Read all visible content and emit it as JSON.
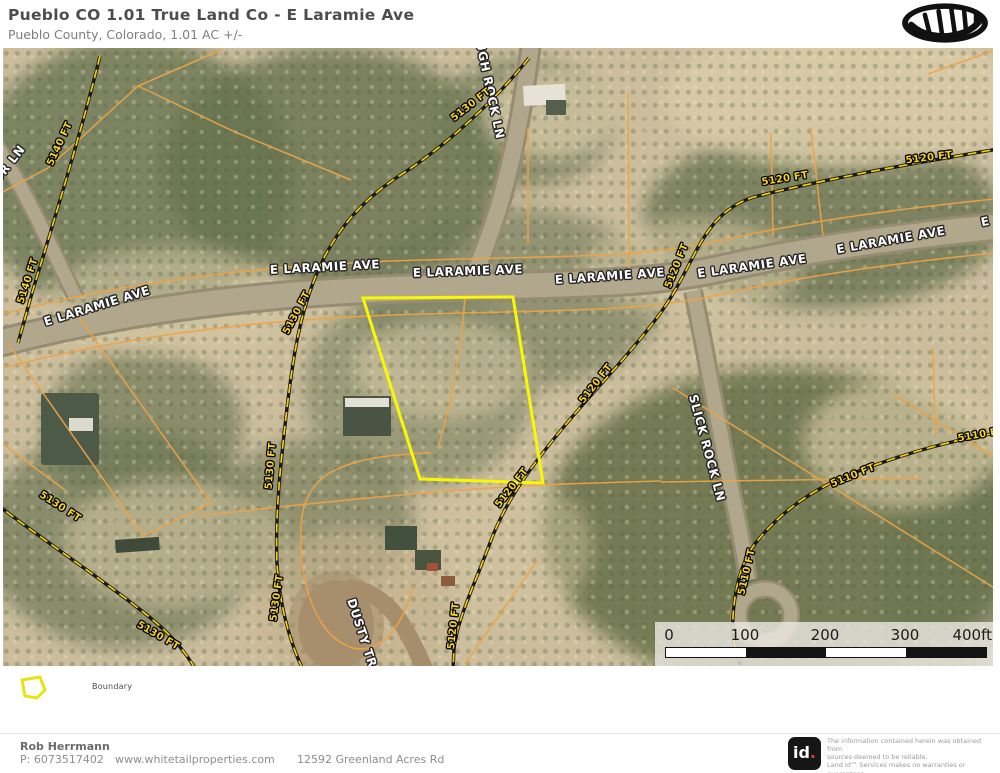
{
  "header": {
    "title": "Pueblo CO 1.01 True Land Co - E Laramie Ave",
    "subtitle": "Pueblo County, Colorado, 1.01 AC +/-"
  },
  "map": {
    "boundary_color": "#f8f800",
    "contour_color": "#f3cd0a",
    "parcel_color": "#efa344",
    "road_labels": [
      {
        "text": "E LARAMIE AVE",
        "x": 94,
        "y": 258,
        "rot": -17
      },
      {
        "text": "E LARAMIE AVE",
        "x": 322,
        "y": 219,
        "rot": -3
      },
      {
        "text": "E LARAMIE AVE",
        "x": 465,
        "y": 223,
        "rot": -2
      },
      {
        "text": "E LARAMIE AVE",
        "x": 607,
        "y": 228,
        "rot": -4
      },
      {
        "text": "E LARAMIE AVE",
        "x": 749,
        "y": 218,
        "rot": -8
      },
      {
        "text": "E LARAMIE AVE",
        "x": 888,
        "y": 192,
        "rot": -10
      },
      {
        "text": "E LARAMIE AVE",
        "x": 1032,
        "y": 163,
        "rot": -12
      },
      {
        "text": "UR LN",
        "x": 6,
        "y": 116,
        "rot": -52
      },
      {
        "text": "UGH ROCK LN",
        "x": 487,
        "y": 42,
        "rot": 78
      },
      {
        "text": "SLICK ROCK LN",
        "x": 704,
        "y": 400,
        "rot": 75
      },
      {
        "text": "DUSTY TR",
        "x": 359,
        "y": 585,
        "rot": 72
      }
    ],
    "contour_labels": [
      {
        "text": "5140 FT",
        "x": 57,
        "y": 96,
        "rot": -65
      },
      {
        "text": "5140 FT",
        "x": 25,
        "y": 233,
        "rot": -72
      },
      {
        "text": "5130 FT",
        "x": 468,
        "y": 57,
        "rot": -38
      },
      {
        "text": "5130 FT",
        "x": 294,
        "y": 265,
        "rot": -62
      },
      {
        "text": "5130 FT",
        "x": 268,
        "y": 418,
        "rot": -85
      },
      {
        "text": "5130 FT",
        "x": 274,
        "y": 550,
        "rot": -82
      },
      {
        "text": "5130 FT",
        "x": 57,
        "y": 459,
        "rot": 33
      },
      {
        "text": "5130 FT",
        "x": 155,
        "y": 588,
        "rot": 30
      },
      {
        "text": "5120 FT",
        "x": 782,
        "y": 131,
        "rot": -9
      },
      {
        "text": "5120 FT",
        "x": 926,
        "y": 110,
        "rot": -7
      },
      {
        "text": "5120 FT",
        "x": 674,
        "y": 218,
        "rot": -68
      },
      {
        "text": "5120 FT",
        "x": 593,
        "y": 336,
        "rot": -52
      },
      {
        "text": "5120 FT",
        "x": 509,
        "y": 440,
        "rot": -52
      },
      {
        "text": "5120 FT",
        "x": 451,
        "y": 578,
        "rot": -84
      },
      {
        "text": "5110 FT",
        "x": 978,
        "y": 387,
        "rot": -10
      },
      {
        "text": "5110 FT",
        "x": 850,
        "y": 428,
        "rot": -22
      },
      {
        "text": "5110 FT",
        "x": 744,
        "y": 524,
        "rot": -77
      }
    ],
    "scale_bar": {
      "ticks": [
        "0",
        "100",
        "200",
        "300"
      ],
      "end_label": "400ft"
    },
    "legend": {
      "boundary_label": "Boundary"
    }
  },
  "footer": {
    "agent_name": "Rob Herrmann",
    "phone": "P: 6073517402",
    "website": "www.whitetailproperties.com",
    "address": "12592 Greenland Acres Rd"
  },
  "branding": {
    "id_logo_text": "id",
    "id_logo_dot": "."
  },
  "disclaimer": {
    "lines": [
      "The information contained herein was obtained from",
      "sources deemed to be reliable.",
      " Land id™  Services makes no warranties or guarantees",
      "as to the completeness or accuracy thereof."
    ]
  }
}
